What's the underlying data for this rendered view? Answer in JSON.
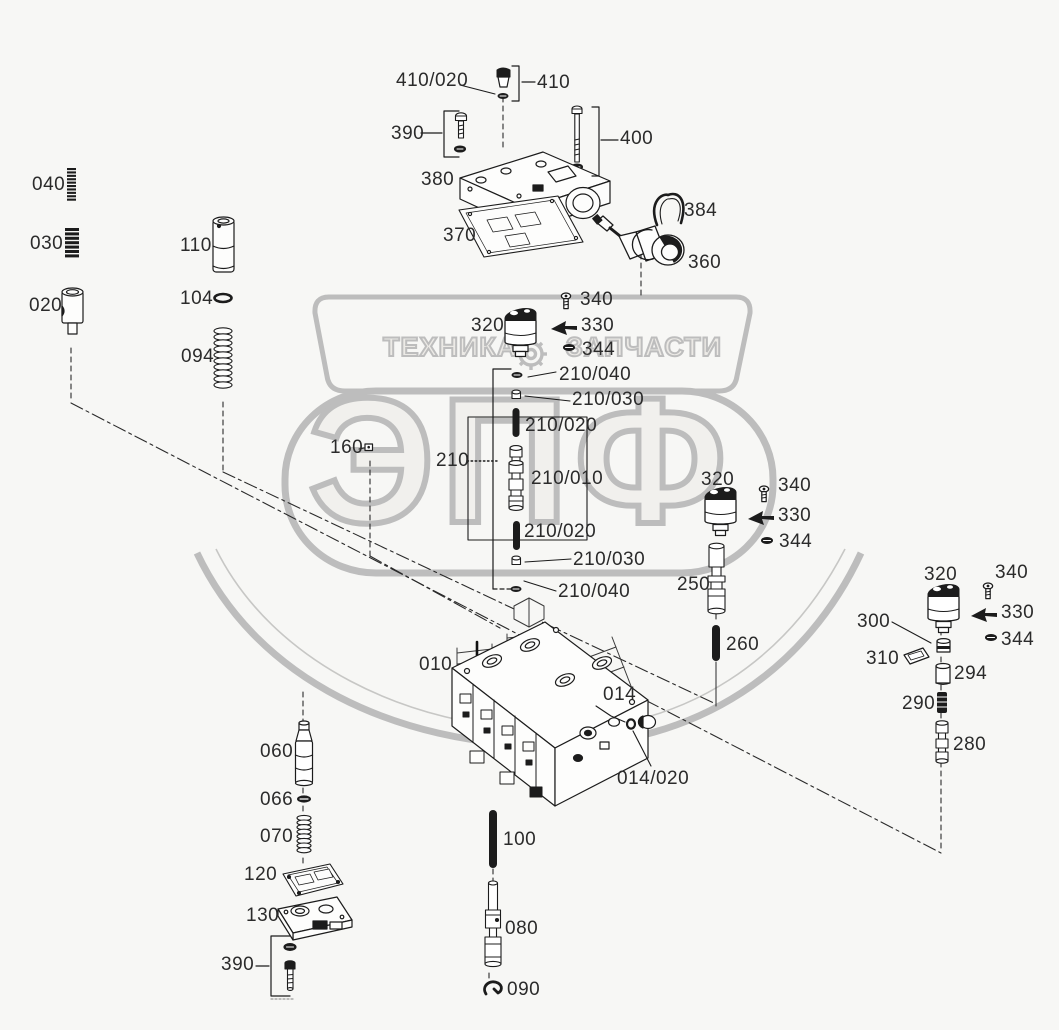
{
  "title": "parts-exploded-diagram",
  "colors": {
    "background": "#f7f7f5",
    "line": "#1c1c1c",
    "label": "#2b2b2b",
    "watermark_grey": "#bdbdbd"
  },
  "watermark": {
    "banner_left": "ТЕХНИКА",
    "banner_right": "ЗАПЧАСТИ",
    "gear_icon": "gear-icon",
    "big_text": "ЭПФ"
  },
  "callouts": [
    {
      "id": "410/020-top-seal",
      "text": "410/020"
    },
    {
      "id": "410-plug",
      "text": "410"
    },
    {
      "id": "390-bolt-top",
      "text": "390"
    },
    {
      "id": "400-long-bolt",
      "text": "400"
    },
    {
      "id": "380-housing",
      "text": "380"
    },
    {
      "id": "370-gasket",
      "text": "370"
    },
    {
      "id": "384-clip",
      "text": "384"
    },
    {
      "id": "360-sensor",
      "text": "360"
    },
    {
      "id": "040-spring",
      "text": "040"
    },
    {
      "id": "030-spring",
      "text": "030"
    },
    {
      "id": "020-bushing",
      "text": "020"
    },
    {
      "id": "110-piston",
      "text": "110"
    },
    {
      "id": "104-oring",
      "text": "104"
    },
    {
      "id": "094-spring",
      "text": "094"
    },
    {
      "id": "320-solenoid-a",
      "text": "320"
    },
    {
      "id": "340-screw-a",
      "text": "340"
    },
    {
      "id": "330-clip-a",
      "text": "330"
    },
    {
      "id": "344-seal-a",
      "text": "344"
    },
    {
      "id": "210/040-seal-top",
      "text": "210/040"
    },
    {
      "id": "210/030-cap-top",
      "text": "210/030"
    },
    {
      "id": "210/020-pin-top",
      "text": "210/020"
    },
    {
      "id": "210-group",
      "text": "210"
    },
    {
      "id": "210/010-spool",
      "text": "210/010"
    },
    {
      "id": "210/020-pin-bottom",
      "text": "210/020"
    },
    {
      "id": "210/030-cap-bottom",
      "text": "210/030"
    },
    {
      "id": "210/040-seal-bottom",
      "text": "210/040"
    },
    {
      "id": "160-plug",
      "text": "160"
    },
    {
      "id": "320-solenoid-b",
      "text": "320"
    },
    {
      "id": "340-screw-b",
      "text": "340"
    },
    {
      "id": "330-clip-b",
      "text": "330"
    },
    {
      "id": "344-seal-b",
      "text": "344"
    },
    {
      "id": "250-spool",
      "text": "250"
    },
    {
      "id": "260-pin",
      "text": "260"
    },
    {
      "id": "320-solenoid-c",
      "text": "320"
    },
    {
      "id": "340-screw-c",
      "text": "340"
    },
    {
      "id": "330-clip-c",
      "text": "330"
    },
    {
      "id": "344-seal-c",
      "text": "344"
    },
    {
      "id": "300-bushing",
      "text": "300"
    },
    {
      "id": "310-shim",
      "text": "310"
    },
    {
      "id": "294-sleeve",
      "text": "294"
    },
    {
      "id": "290-pin",
      "text": "290"
    },
    {
      "id": "280-spool",
      "text": "280"
    },
    {
      "id": "010-valve-body",
      "text": "010"
    },
    {
      "id": "014-plug",
      "text": "014"
    },
    {
      "id": "014/020-seal",
      "text": "014/020"
    },
    {
      "id": "060-piston",
      "text": "060"
    },
    {
      "id": "066-seal",
      "text": "066"
    },
    {
      "id": "070-spring",
      "text": "070"
    },
    {
      "id": "120-gasket",
      "text": "120"
    },
    {
      "id": "130-plate",
      "text": "130"
    },
    {
      "id": "390-bolt-bottom",
      "text": "390"
    },
    {
      "id": "100-pin",
      "text": "100"
    },
    {
      "id": "080-spool",
      "text": "080"
    },
    {
      "id": "090-clip",
      "text": "090"
    }
  ]
}
